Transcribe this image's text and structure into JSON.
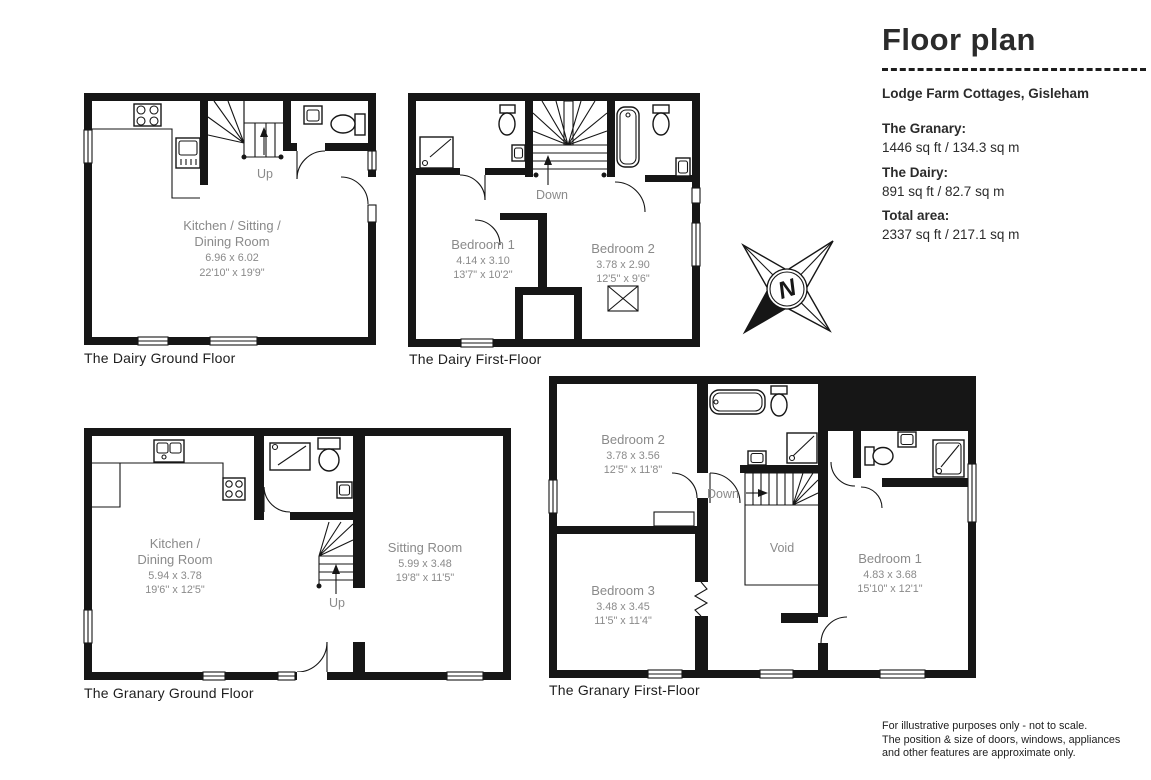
{
  "panel": {
    "title": "Floor plan",
    "address": "Lodge Farm Cottages, Gisleham",
    "areas": [
      {
        "label": "The Granary:",
        "value": "1446 sq ft / 134.3 sq m"
      },
      {
        "label": "The Dairy:",
        "value": "891 sq ft / 82.7 sq m"
      },
      {
        "label": "Total area:",
        "value": "2337 sq ft / 217.1 sq m"
      }
    ],
    "disclaimer_lines": [
      "For illustrative purposes only - not to scale.",
      "The position & size of doors, windows, appliances",
      "and other features are approximate only."
    ]
  },
  "compass": {
    "letter": "N"
  },
  "colors": {
    "wall": "#161616",
    "room_label": "#8a8a8a"
  },
  "plans": {
    "dairy_ground": {
      "caption": "The Dairy Ground Floor",
      "stair_label": "Up",
      "room": {
        "line1": "Kitchen / Sitting /",
        "line2": "Dining Room",
        "metric": "6.96 x 6.02",
        "imperial": "22'10\" x 19'9\""
      }
    },
    "dairy_first": {
      "caption": "The Dairy First-Floor",
      "stair_label": "Down",
      "bedroom1": {
        "name": "Bedroom 1",
        "metric": "4.14 x 3.10",
        "imperial": "13'7\" x 10'2''"
      },
      "bedroom2": {
        "name": "Bedroom 2",
        "metric": "3.78 x 2.90",
        "imperial": "12'5'' x 9'6\""
      }
    },
    "granary_ground": {
      "caption": "The Granary Ground Floor",
      "stair_label": "Up",
      "kitchen": {
        "line1": "Kitchen /",
        "line2": "Dining Room",
        "metric": "5.94 x 3.78",
        "imperial": "19'6'' x 12'5\""
      },
      "sitting": {
        "name": "Sitting Room",
        "metric": "5.99 x 3.48",
        "imperial": "19'8\" x 11'5\""
      }
    },
    "granary_first": {
      "caption": "The Granary First-Floor",
      "stair_label": "Down",
      "void_label": "Void",
      "bedroom1": {
        "name": "Bedroom 1",
        "metric": "4.83 x 3.68",
        "imperial": "15'10\" x 12'1\""
      },
      "bedroom2": {
        "name": "Bedroom 2",
        "metric": "3.78 x 3.56",
        "imperial": "12'5\" x 11'8\""
      },
      "bedroom3": {
        "name": "Bedroom 3",
        "metric": "3.48 x 3.45",
        "imperial": "11'5\" x 11'4\""
      }
    }
  }
}
